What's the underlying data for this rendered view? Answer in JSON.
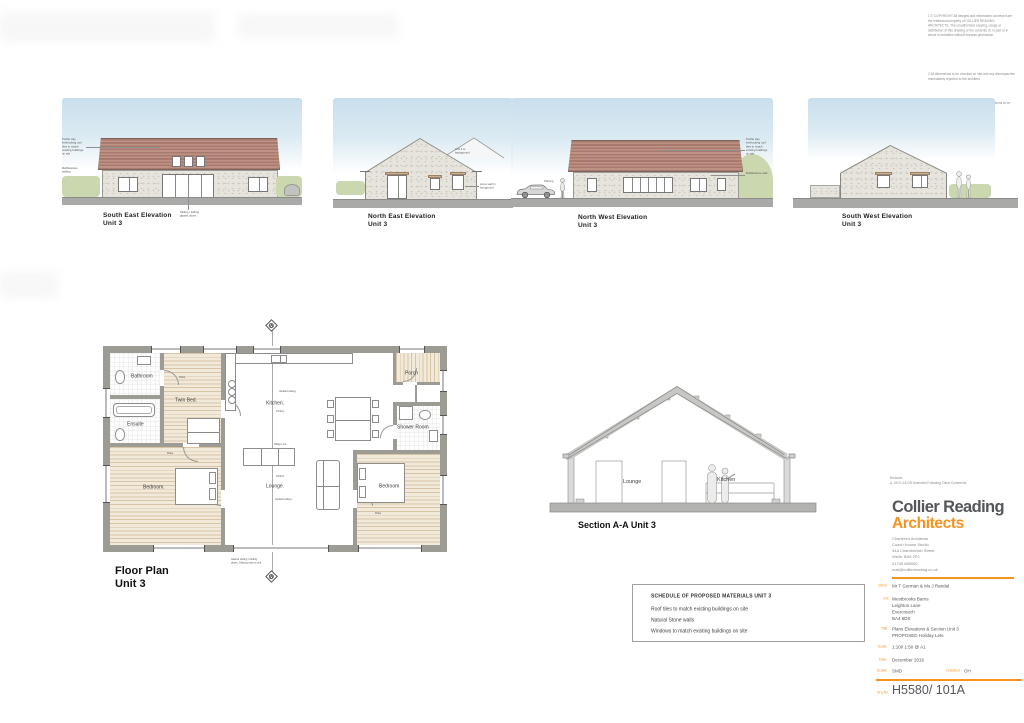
{
  "colors": {
    "brand_orange": "#f6921e",
    "logo_gray": "#55565a",
    "roof_tile": "#ab7d70"
  },
  "sheet": {
    "notes": [
      "1 © COPYRIGHT All designs and information conveyed are the intellectual property of COLLIER READING ARCHITECTS. The unauthorised copying, usage or distribution of this drawing or the contents of, in part or in whole is forbidden without express permission.",
      "2 All dimensions to be checked on site and any discrepancies immediately reported to the architect.",
      "3 Do not scale from this drawing, figured dimensions to be taken only."
    ]
  },
  "elevations": {
    "se": {
      "title": "South East Elevation",
      "unit": "Unit 3",
      "note_roof": "Profile clay interlocking roof tiles to match existing buildings on site",
      "note_wall": "Rubblestone walling",
      "note_doors": "Sliding / folding glazed doors"
    },
    "ne": {
      "title": "North East Elevation",
      "unit": "Unit 3",
      "note_bg": "Unit 4 in background",
      "note_wall": "stone wall in foreground"
    },
    "nw": {
      "title": "North West Elevation",
      "unit": "Unit 3",
      "note_parking": "Parking",
      "note_roof": "Profile clay interlocking roof tiles to match existing buildings on site",
      "note_wall": "Rubblestone wall"
    },
    "sw": {
      "title": "South West Elevation",
      "unit": "Unit 3"
    }
  },
  "floor_plan": {
    "title": "Floor Plan",
    "unit": "Unit 3",
    "rooms": {
      "bathroom": "Bathroom",
      "twin": "Twin Bed.",
      "kitchen": "Kitchen.",
      "ensuite": "Ensuite",
      "bedroom_l": "Bedroom.",
      "lounge": "Lounge.",
      "bedroom_r": "Bedroom",
      "shower": "Shower Room",
      "porch": "Porch"
    },
    "annotations": {
      "vaulted": "Vaulted ceiling",
      "purlins": "Purlins",
      "ridge": "Ridge Line",
      "robe": "Robe",
      "glazed": "Glazed sliding / folding doors. Glazing ratio to suit"
    },
    "section_marker": "A"
  },
  "section": {
    "title": "Section A-A Unit 3",
    "label_lounge": "Lounge",
    "label_kitchen": "Kitchen"
  },
  "schedule": {
    "title": "SCHEDULE OF PROPOSED MATERIALS  UNIT 3",
    "items": [
      "Roof tiles to match existing buildings on site",
      "Natural Stone walls",
      "Windows to match existing buildings on site"
    ]
  },
  "title_block": {
    "revision_label": "Revision:",
    "revision": "A. 09.01.18 OH Amended Following Client Comments",
    "logo_line1": "Collier Reading",
    "logo_line2": "Architects",
    "address": "Chartered Architects\nCoach House Studio\n34A Chamberlain Street\nWells, BA5 2PJ",
    "phone": "01749 689060",
    "email": "mail@collierreading.co.uk",
    "labels": {
      "client": "Client",
      "job": "Job",
      "title": "Title",
      "scale": "Scale",
      "date": "Date",
      "drawn": "Drawn",
      "checked": "Checked",
      "drg_no": "Drg No"
    },
    "values": {
      "client": "Mr T Gorman & Ms J Randal",
      "job": "Westbrooks Barns\nLeighton Lane\nEvercreech\nBA4 6DS",
      "title": "Plans Elevations & Section Unit 3\nPROPOSED Holiday Lets",
      "scale": "1:100 1:50 @ A1",
      "date": "December 2016",
      "drawn": "SMD",
      "checked": "OH",
      "drg_no": "H5580/ 101A"
    }
  }
}
